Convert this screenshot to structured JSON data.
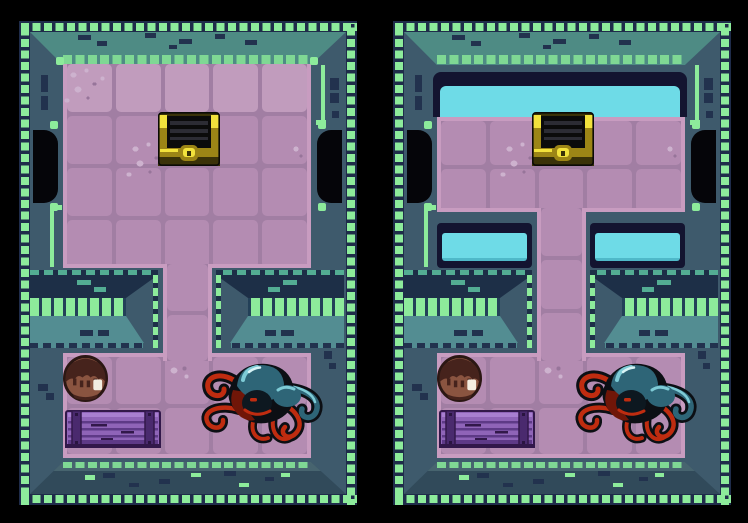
{
  "window": {
    "width": 748,
    "height": 523,
    "background": "#000000",
    "description": "Two side-by-side top-down pixel-art views of the same dungeon room; the right view shows flooded water channels (cyan) in the top row and in two alcoves beside the corridor."
  },
  "palette": {
    "bg": "#000000",
    "border_navy": "#1f2c4a",
    "tick": "#8deb9b",
    "tick_dim": "#7fd894",
    "teal_dash": "#53ad93",
    "wall": "#3e5a6c",
    "wall_light": "#47646f",
    "wall_dark": "#314a5a",
    "teal_band": "#4e8b84",
    "teal_face": "#538d92",
    "navy": "#22324e",
    "ledge_navy": "#1d2f47",
    "grout": "#a17ea3",
    "tile": "#b48cb2",
    "tile_light": "#c19cbd",
    "edge_pink": "#c89cc0",
    "peb_light": "#cdb2ce",
    "peb_dark": "#97759a",
    "water": "#6edbe7",
    "water_deep": "#4fb9c9",
    "water_frame": "#131430",
    "door": "#050509",
    "chest_dark": "#3a3208",
    "chest_stripe": "#2c2c34",
    "chest_gold": "#9c8516",
    "chest_yellow": "#f2e23c",
    "player_outline": "#2b1713",
    "player_dark": "#46231c",
    "player_face": "#8a5440",
    "player_shine": "#f3eee2",
    "crate_outline": "#32184a",
    "crate_body": "#8f64b8",
    "crate_light": "#a87fd0",
    "crate_dark": "#5e3a87",
    "crate_rail": "#4a2a6e",
    "octo_black": "#0c0f14",
    "octo_red": "#bf2c10",
    "octo_red_dark": "#701608",
    "octo_teal": "#2e6577",
    "octo_teal_light": "#7ecbd6",
    "octo_highlight": "#d8f4f6"
  },
  "room": {
    "top_room": {
      "cols": 5,
      "rows": 4
    },
    "corridor": {
      "cols": 1
    },
    "bottom_room": {
      "cols": 5,
      "rows": 2
    },
    "doors": [
      "west-door",
      "east-door"
    ],
    "ledges": [
      "left-ledge",
      "right-ledge"
    ]
  },
  "panels": [
    {
      "name": "room-view-dry",
      "water_revealed": false,
      "entities": [
        {
          "name": "treasure-chest",
          "location": "top room, center column, second row"
        },
        {
          "name": "player-character",
          "location": "bottom room, first column, first row"
        },
        {
          "name": "purple-crate",
          "location": "bottom room, columns 1-2, second row"
        },
        {
          "name": "octopus-monster",
          "location": "bottom room, right side"
        }
      ]
    },
    {
      "name": "room-view-flooded",
      "water_revealed": true,
      "entities": [
        {
          "name": "treasure-chest",
          "location": "top room, center column, second row"
        },
        {
          "name": "player-character",
          "location": "bottom room, first column, first row"
        },
        {
          "name": "purple-crate",
          "location": "bottom room, columns 1-2, second row"
        },
        {
          "name": "octopus-monster",
          "location": "bottom room, right side"
        }
      ],
      "water_regions": [
        {
          "name": "top-water-channel",
          "location": "top room, first row, full width"
        },
        {
          "name": "left-water-alcove",
          "location": "left of corridor, below top room"
        },
        {
          "name": "right-water-alcove",
          "location": "right of corridor, below top room"
        }
      ]
    }
  ]
}
